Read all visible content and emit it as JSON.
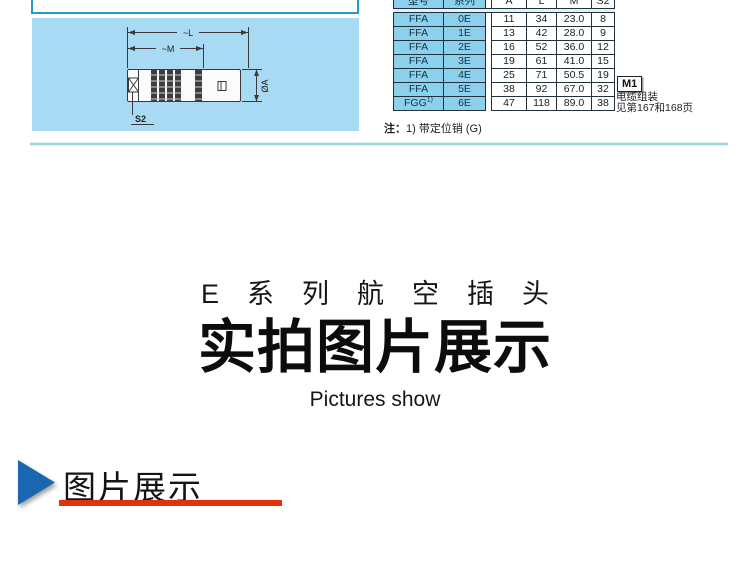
{
  "top": {
    "diagram_labels": {
      "l": "~L",
      "m": "~M",
      "a": "ØA",
      "s2": "S2"
    },
    "table": {
      "headers": [
        "型号",
        "系列",
        "A",
        "L",
        "M",
        "S2"
      ],
      "rows": [
        [
          "FFA",
          "0E",
          "11",
          "34",
          "23.0",
          "8"
        ],
        [
          "FFA",
          "1E",
          "13",
          "42",
          "28.0",
          "9"
        ],
        [
          "FFA",
          "2E",
          "16",
          "52",
          "36.0",
          "12"
        ],
        [
          "FFA",
          "3E",
          "19",
          "61",
          "41.0",
          "15"
        ],
        [
          "FFA",
          "4E",
          "25",
          "71",
          "50.5",
          "19"
        ],
        [
          "FFA",
          "5E",
          "38",
          "92",
          "67.0",
          "32"
        ],
        [
          "FGG",
          "6E",
          "47",
          "118",
          "89.0",
          "38"
        ]
      ],
      "fgg_superscript": "1)"
    },
    "m1_box": {
      "label": "M1",
      "note_line1": "电缆组装",
      "note_line2": "见第167和168页"
    },
    "footnote": {
      "prefix": "注：",
      "text": "1) 带定位销 (G)"
    }
  },
  "middle": {
    "series_line": "E系列航空插头",
    "headline": "实拍图片展示",
    "subline": "Pictures show"
  },
  "bottom": {
    "section_title": "图片展示"
  },
  "colors": {
    "panel_blue": "#a9daf3",
    "cell_blue": "#8bd0ec",
    "box_border_teal": "#1f9bc6",
    "divider_blue": "#9ed2e5",
    "triangle_blue": "#1a66b0",
    "underline_red": "#e0330d"
  }
}
